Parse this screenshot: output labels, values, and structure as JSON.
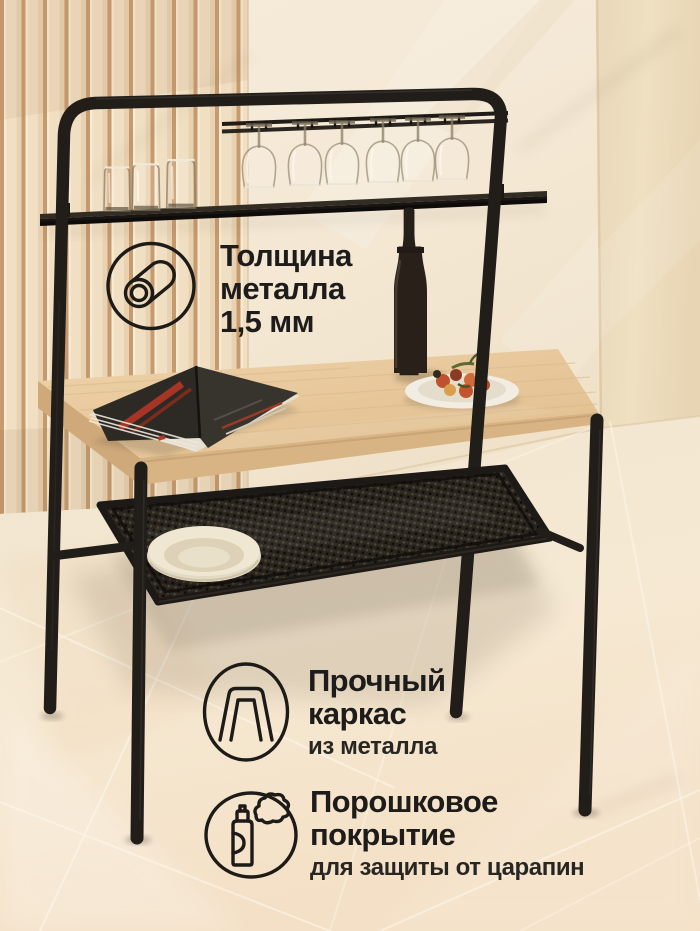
{
  "features": [
    {
      "icon": "metal-thickness-icon",
      "line1": "Толщина",
      "line2": "металла",
      "line3": "1,5 мм"
    },
    {
      "icon": "metal-frame-icon",
      "line1": "Прочный",
      "line2": "каркас",
      "subtitle": "из металла"
    },
    {
      "icon": "spray-can-icon",
      "line1": "Порошковое",
      "line2": "покрытие",
      "subtitle": "для защиты от царапин"
    }
  ],
  "colors": {
    "text": "#1d1c1a",
    "frame_black": "#211d19",
    "tabletop_wood": "#e8caa0",
    "wall": "#f4e9d6",
    "slat_groove": "#c79a6d",
    "floor": "#f2e7d2",
    "magazine_red": "#a63526"
  }
}
